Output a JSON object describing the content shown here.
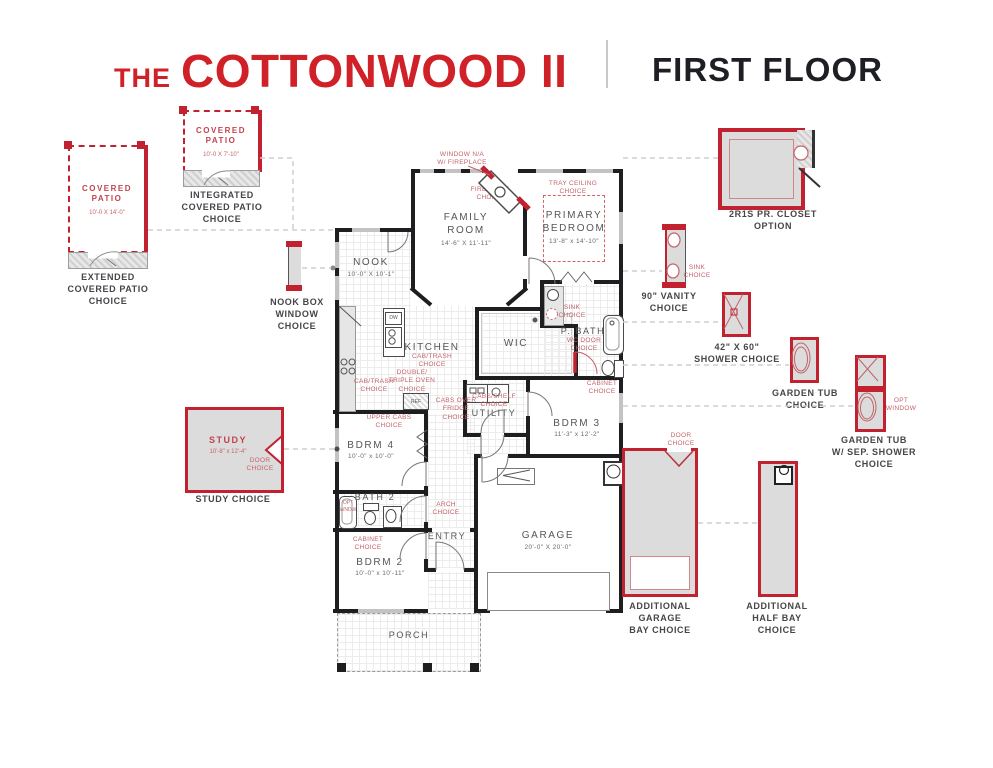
{
  "header": {
    "prefix": "THE",
    "title": "COTTONWOOD II",
    "floor": "FIRST FLOOR"
  },
  "colors": {
    "red": "#c22130",
    "soft_red": "#c4636b",
    "wall": "#1e1e20",
    "gray_fill": "#dcdcdc",
    "caption": "#46464a"
  },
  "rooms": {
    "family": {
      "name": "FAMILY\nROOM",
      "dims": "14'-6\" X 11'-11\""
    },
    "primary": {
      "name": "PRIMARY\nBEDROOM",
      "dims": "13'-8\" x 14'-10\""
    },
    "nook": {
      "name": "NOOK",
      "dims": "10'-0\" X 10'-1\""
    },
    "kitchen": {
      "name": "KITCHEN"
    },
    "wic": {
      "name": "WIC"
    },
    "pbath": {
      "name": "P. BATH"
    },
    "utility": {
      "name": "UTILITY"
    },
    "bdrm3": {
      "name": "BDRM 3",
      "dims": "11'-3\" x 12'-2\""
    },
    "bdrm4": {
      "name": "BDRM 4",
      "dims": "10'-0\" x 10'-0\""
    },
    "bath2": {
      "name": "BATH 2"
    },
    "entry": {
      "name": "ENTRY"
    },
    "bdrm2": {
      "name": "BDRM 2",
      "dims": "10'-0\" x 10'-11\""
    },
    "garage": {
      "name": "GARAGE",
      "dims": "20'-0\" X 20'-0\""
    },
    "porch": {
      "name": "PORCH"
    }
  },
  "annotations": {
    "window_na": "WINDOW N/A\nW/ FIREPLACE",
    "fireplace": "FIREPLACE\nCHOICE",
    "tray": "TRAY CEILING\nCHOICE",
    "sink_pbath": "SINK\nCHOICE",
    "wc_door": "WC DOOR\nCHOICE",
    "cabinet_pbath": "CABINET\nCHOICE",
    "cab_trash_island": "CAB/TRASH\nCHOICE",
    "cab_trash_wall": "CAB/TRASH\nCHOICE",
    "double_oven": "DOUBLE/\nTRIPLE OVEN\nCHOICE",
    "cabs_over_fridge": "CABS OVER\nFRIDGE\nCHOICE",
    "upper_cabs": "UPPER CABS\nCHOICE",
    "cabs_shelf": "CABS/SHELF\nCHOICE",
    "arch": "ARCH\nCHOICE",
    "cabinet_bath2": "CABINET\nCHOICE",
    "opt_wndw": "OPT\nWNDW",
    "dw": "DW",
    "ref": "REF"
  },
  "options": {
    "integrated_patio": {
      "title": "COVERED\nPATIO",
      "dims": "10'-0 X 7'-10\"",
      "caption": "INTEGRATED\nCOVERED PATIO\nCHOICE"
    },
    "extended_patio": {
      "title": "COVERED\nPATIO",
      "dims": "10'-0 X 14'-0\"",
      "caption": "EXTENDED\nCOVERED PATIO\nCHOICE"
    },
    "nook_box": {
      "caption": "NOOK BOX\nWINDOW\nCHOICE"
    },
    "study": {
      "title": "STUDY",
      "dims": "10'-8\" x 12'-4\"",
      "door": "DOOR\nCHOICE",
      "caption": "STUDY CHOICE"
    },
    "closet": {
      "caption": "2R1S PR. CLOSET\nOPTION"
    },
    "vanity": {
      "sink": "SINK\nCHOICE",
      "caption": "90\" VANITY\nCHOICE"
    },
    "shower": {
      "caption": "42\" X 60\"\nSHOWER CHOICE"
    },
    "garden_tub": {
      "caption": "GARDEN TUB\nCHOICE"
    },
    "garden_tub_shower": {
      "opt": "OPT\nWINDOW",
      "caption": "GARDEN TUB\nW/ SEP. SHOWER\nCHOICE"
    },
    "add_garage": {
      "door": "DOOR\nCHOICE",
      "caption": "ADDITIONAL\nGARAGE\nBAY CHOICE"
    },
    "add_half_bay": {
      "caption": "ADDITIONAL\nHALF BAY\nCHOICE"
    }
  }
}
